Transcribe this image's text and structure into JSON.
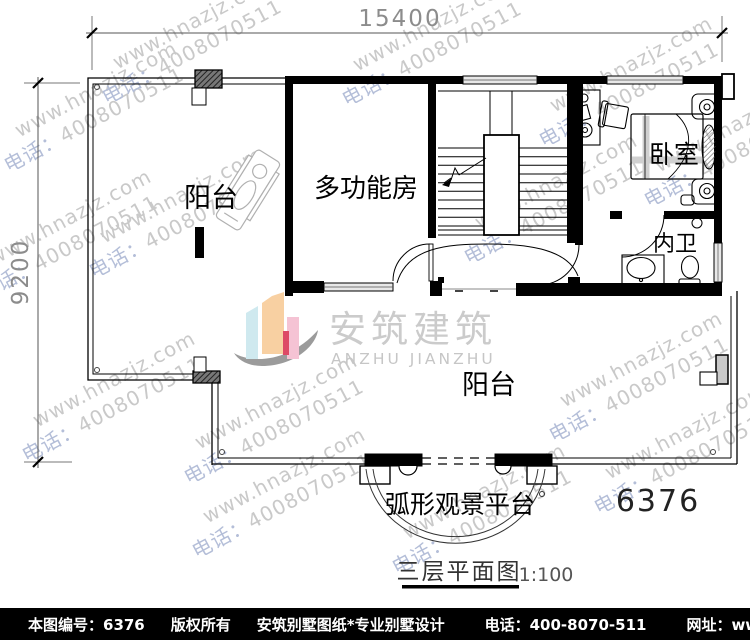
{
  "plan": {
    "number": "6376",
    "title": "三层平面图",
    "scale": "1:100"
  },
  "dimensions": {
    "top_width": "15400",
    "left_height": "9200"
  },
  "rooms": {
    "balcony_top": "阳台",
    "multi_function": "多功能房",
    "bedroom": "卧室",
    "inner_bath": "内卫",
    "balcony_bottom": "阳台",
    "arc_platform": "弧形观景平台"
  },
  "logo": {
    "cn": "安筑建筑",
    "en": "ANZHU JIANZHU"
  },
  "watermark": {
    "site": "www.hnazjz.com",
    "phone_label": "电话：",
    "phone_digits": "4008070511"
  },
  "footer": {
    "sheet_no": "本图编号：6376",
    "copyright": "版权所有",
    "studio": "安筑别墅图纸*专业别墅设计",
    "phone": "电话：400-8070-511",
    "site": "网址：www.hnazjz.com"
  },
  "colors": {
    "wall": "#000000",
    "dim_text": "#8c8c8c",
    "watermark_gray": "#c9c9c9",
    "watermark_blue": "#b4bed8",
    "logo_text": "#cbcbcb",
    "logo_cyan": "#cfe9ef",
    "logo_peach": "#f8d0a2",
    "logo_pink": "#f5c3d4",
    "logo_red": "#dd4a66",
    "logo_swoosh": "#9b9b9b",
    "footer_bg": "#000000",
    "footer_text": "#ffffff"
  }
}
